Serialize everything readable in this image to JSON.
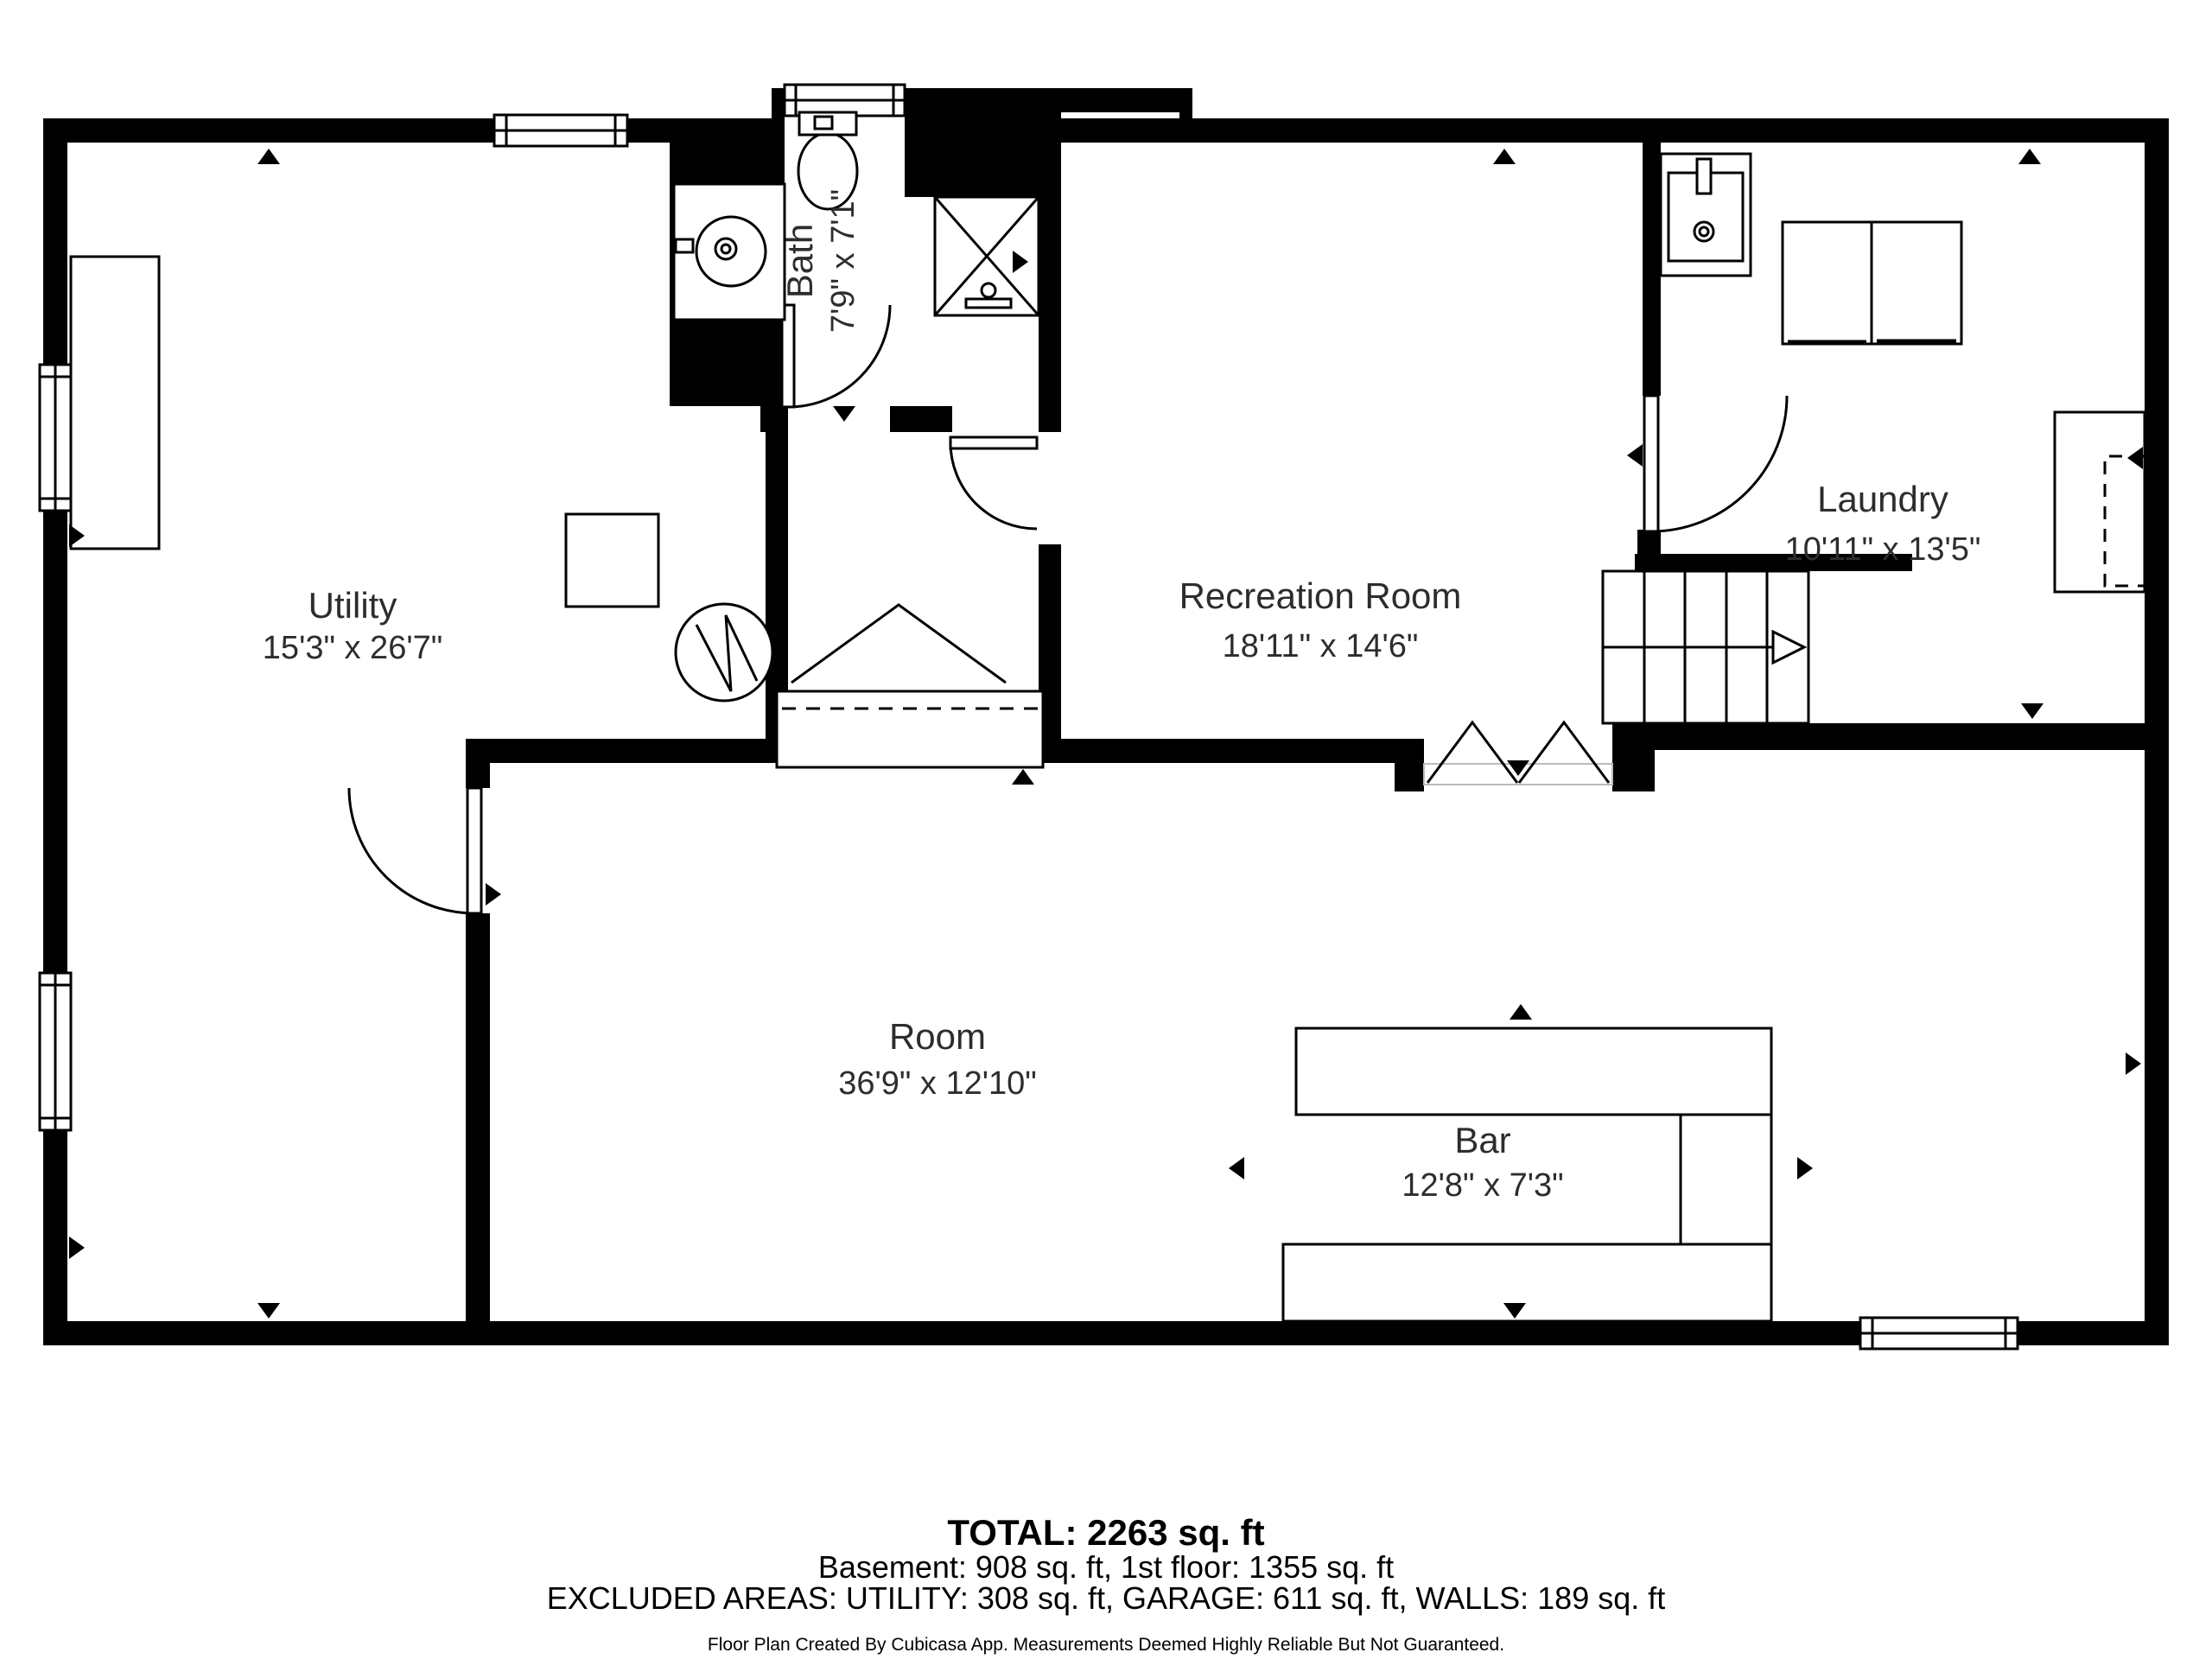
{
  "plan": {
    "type": "floor-plan",
    "creator_note": "Floor Plan Created By Cubicasa App. Measurements Deemed Highly Reliable But Not Guaranteed.",
    "rooms": {
      "utility": {
        "name": "Utility",
        "dims": "15'3\" x 26'7\""
      },
      "bath": {
        "name": "Bath",
        "dims": "7'9\" x 7'1\""
      },
      "recreation": {
        "name": "Recreation Room",
        "dims": "18'11\" x 14'6\""
      },
      "laundry": {
        "name": "Laundry",
        "dims": "10'11\" x 13'5\""
      },
      "room": {
        "name": "Room",
        "dims": "36'9\" x 12'10\""
      },
      "bar": {
        "name": "Bar",
        "dims": "12'8\" x 7'3\""
      }
    },
    "footer": {
      "total": "TOTAL: 2263 sq. ft",
      "floors": "Basement: 908 sq. ft, 1st floor: 1355 sq. ft",
      "excluded": "EXCLUDED AREAS: UTILITY: 308 sq. ft, GARAGE: 611 sq. ft, WALLS: 189 sq. ft",
      "disclaimer": "Floor Plan Created By Cubicasa App. Measurements Deemed Highly Reliable But Not Guaranteed."
    },
    "colors": {
      "wall": "#000000",
      "background": "#ffffff",
      "label": "#2d2d2d"
    }
  }
}
